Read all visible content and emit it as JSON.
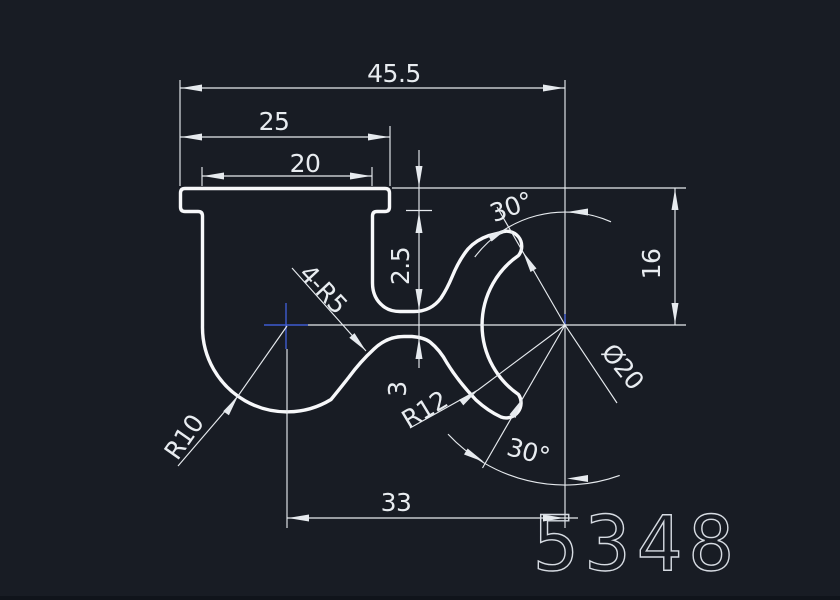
{
  "title": "CAD profile section drawing",
  "theme": {
    "bg": "#181c24",
    "line": "#e6eaee",
    "profile": "#f7f8fa",
    "text": "#e8ecf0",
    "accent": "#3d5bd0",
    "part_text": "#d6dbe2",
    "edge": "#10141b"
  },
  "dimensions": {
    "total_width": "45.5",
    "flange_width": "25",
    "wall_span": "20",
    "flange_thickness": "2.5",
    "web_thickness": "3",
    "right_height": "16",
    "bottom_width": "33",
    "angle_top": "30°",
    "angle_bottom": "30°",
    "mouth_diameter": "Ø20",
    "radius_arm": "R12",
    "radius_bottom": "R10",
    "fillets_note": "4-R5"
  },
  "part_number": "5348"
}
